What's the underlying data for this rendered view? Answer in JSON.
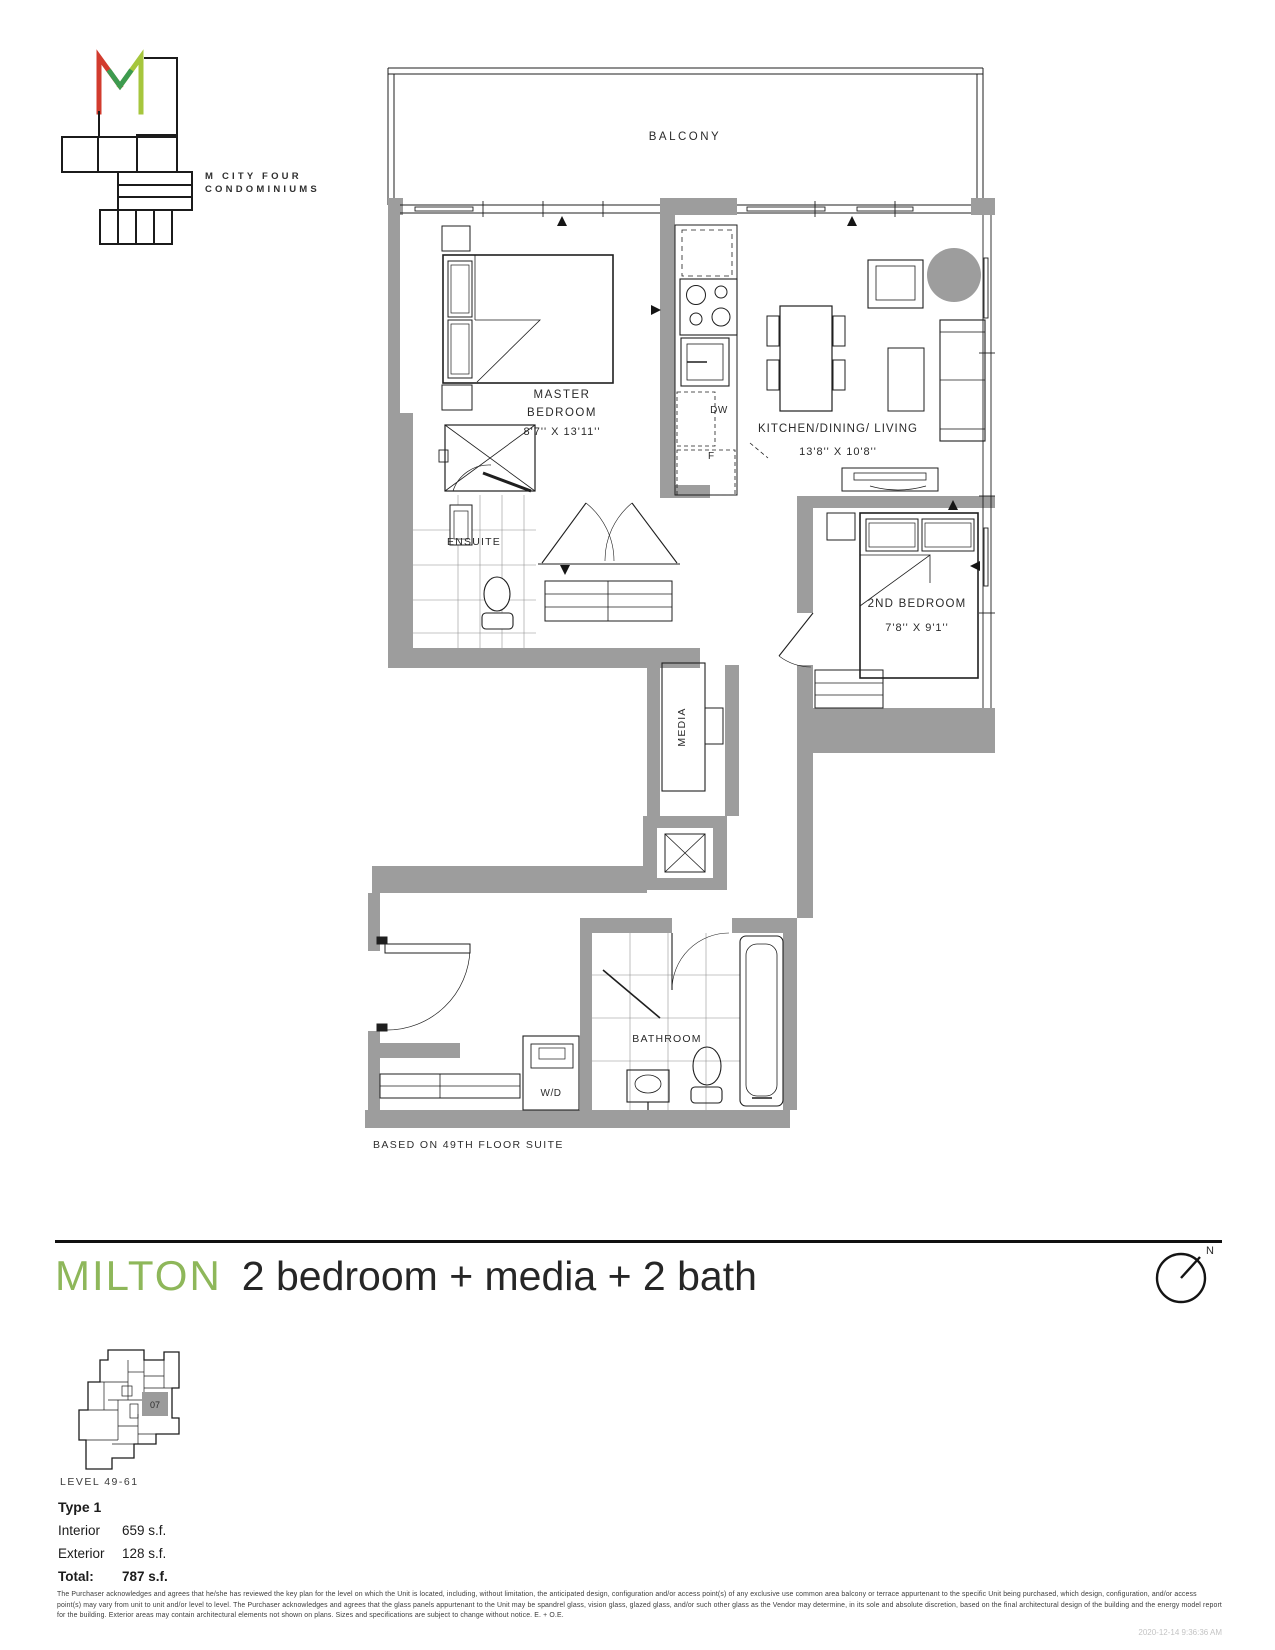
{
  "branding": {
    "name_line1": "M CITY FOUR",
    "name_line2": "CONDOMINIUMS",
    "colors": {
      "red": "#d23b2e",
      "green": "#3d9b4f",
      "lime": "#a6c63d"
    }
  },
  "floorplan": {
    "balcony_label": "BALCONY",
    "master": {
      "line1": "MASTER",
      "line2": "BEDROOM",
      "dims": "8'7'' X 13'11''"
    },
    "kitchen_dining_living": {
      "label": "KITCHEN/DINING/ LIVING",
      "dims": "13'8'' X 10'8''"
    },
    "second_bedroom": {
      "label": "2ND BEDROOM",
      "dims": "7'8'' X 9'1''"
    },
    "ensuite_label": "ENSUITE",
    "media_label": "MEDIA",
    "bathroom_label": "BATHROOM",
    "washer_dryer_label": "W/D",
    "dishwasher_label": "DW",
    "fridge_label": "F",
    "note": "BASED ON 49TH FLOOR SUITE"
  },
  "title": {
    "name": "MILTON",
    "description": "2 bedroom + media + 2 bath",
    "accent_color": "#8eb75a"
  },
  "compass": {
    "north_label": "N"
  },
  "keyplan": {
    "level_label": "LEVEL 49-61",
    "unit_label": "07"
  },
  "areas": {
    "type_label": "Type 1",
    "interior_label": "Interior",
    "interior_value": "659 s.f.",
    "exterior_label": "Exterior",
    "exterior_value": "128 s.f.",
    "total_label": "Total:",
    "total_value": "787 s.f."
  },
  "legal": {
    "disclaimer": "The Purchaser acknowledges and agrees that he/she has reviewed the key plan for the level on which the Unit is located, including, without limitation, the anticipated design, configuration and/or access point(s) of any exclusive use common area balcony or terrace appurtenant to the specific Unit being purchased, which design, configuration, and/or access point(s) may vary from unit to unit and/or level to level. The Purchaser acknowledges and agrees that the glass panels appurtenant to the Unit may be spandrel glass, vision glass, glazed glass, and/or such other glass as the Vendor may determine, in its sole and absolute discretion, based on the final architectural design of the building and the energy model report for the building. Exterior areas may contain architectural elements not shown on plans. Sizes and specifications are subject to change without notice. E. + O.E.",
    "timestamp": "2020-12-14 9:36:36 AM"
  }
}
